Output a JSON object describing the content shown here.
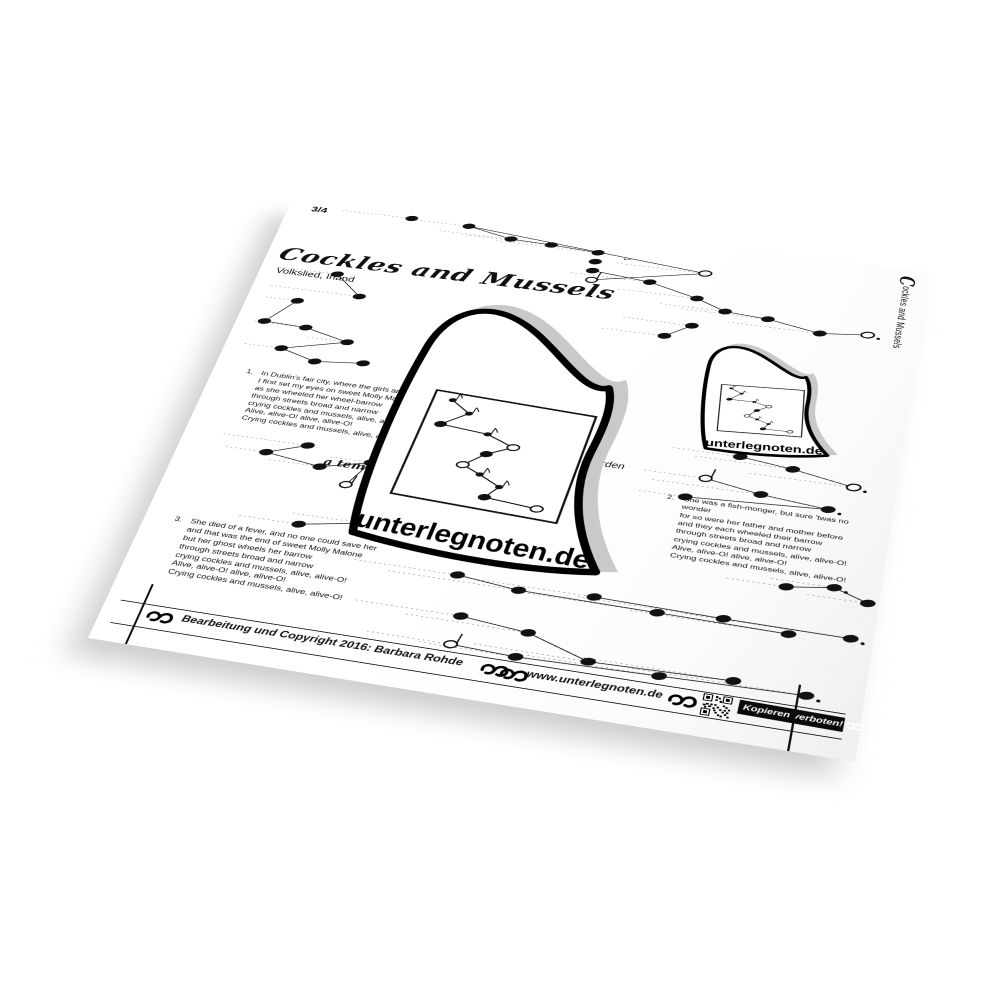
{
  "page": {
    "time_signature": "3/4",
    "title": "Cockles and Mussels",
    "subtitle": "Volkslied, Irland",
    "side_label_initial": "C",
    "side_label_rest": "ockles and Mussels",
    "tempo_a_tempo": "a tempo",
    "tempo_rit": "langsamer werden",
    "verses": [
      {
        "number": "1.",
        "lines": [
          "In Dublin's fair city, where the girls are so pretty",
          "I first set my eyes on sweet Molly Malone",
          "as she wheeled her wheel-barrow",
          "through streets broad and narrow",
          "crying cockles and mussels, alive, alive-O!",
          "Alive, alive-O! alive, alive-O!",
          "Crying cockles and mussels, alive, alive-O!"
        ]
      },
      {
        "number": "2.",
        "lines": [
          "She was a fish-monger, but sure 'twas no wonder",
          "for so were her father and mother before",
          "and they each wheeled their barrow",
          "through streets broad and narrow",
          "crying cockles and mussels, alive, alive-O!",
          "Alive, alive-O! alive, alive-O!",
          "Crying cockles and mussels, alive, alive-O!"
        ]
      },
      {
        "number": "3.",
        "lines": [
          "She died of a fever, and no one could save her",
          "and that was the end of sweet Molly Malone",
          "but her ghost wheels her barrow",
          "through streets broad and narrow",
          "crying cockles and mussels, alive, alive-O!",
          "Alive, alive-O! alive, alive-O!",
          "Crying cockles and mussels, alive, alive-O!"
        ]
      }
    ],
    "footer": {
      "copyright": "Bearbeitung und Copyright 2016: Barbara Rohde",
      "website": "www.unterlegnoten.de",
      "warning": "Kopieren verboten!"
    },
    "logo": {
      "brand": "unterlegnoten.de",
      "motif": [
        [
          12,
          7,
          "s"
        ],
        [
          25,
          17,
          "s"
        ],
        [
          11,
          31,
          "q"
        ],
        [
          41,
          33,
          "s"
        ],
        [
          59,
          41,
          "o"
        ],
        [
          45,
          51,
          "q"
        ],
        [
          34,
          64,
          "o"
        ],
        [
          46,
          70,
          "s"
        ],
        [
          60,
          78,
          "s"
        ],
        [
          54,
          89,
          "q"
        ],
        [
          86,
          91,
          "o"
        ]
      ]
    },
    "notation": {
      "arrow": {
        "x": 378,
        "y": 42,
        "glyph": "←"
      },
      "notes": [
        [
          140,
          12,
          "q"
        ],
        [
          205,
          14,
          "q"
        ],
        [
          255,
          28,
          "q"
        ],
        [
          300,
          30,
          "q"
        ],
        [
          352,
          34,
          "q"
        ],
        [
          352,
          50,
          "q"
        ],
        [
          352,
          66,
          "q"
        ],
        [
          354,
          82,
          "os"
        ],
        [
          470,
          48,
          "o"
        ],
        [
          415,
          74,
          "q"
        ],
        [
          468,
          92,
          "q"
        ],
        [
          500,
          108,
          "q"
        ],
        [
          545,
          112,
          "q"
        ],
        [
          600,
          125,
          "q"
        ],
        [
          648,
          118,
          "o",
          1
        ],
        [
          470,
          138,
          "q"
        ],
        [
          445,
          160,
          "q"
        ],
        [
          85,
          125,
          "q"
        ],
        [
          118,
          158,
          "q"
        ],
        [
          55,
          178,
          "q"
        ],
        [
          30,
          218,
          "q"
        ],
        [
          76,
          220,
          "q"
        ],
        [
          125,
          235,
          "q"
        ],
        [
          60,
          258,
          "q"
        ],
        [
          100,
          272,
          "q"
        ],
        [
          150,
          265,
          "q"
        ],
        [
          128,
          400,
          "q"
        ],
        [
          90,
          418,
          "q"
        ],
        [
          148,
          428,
          "q"
        ],
        [
          196,
          412,
          "q"
        ],
        [
          180,
          448,
          "os"
        ],
        [
          548,
          330,
          "q"
        ],
        [
          600,
          338,
          "q"
        ],
        [
          660,
          352,
          "o",
          1
        ],
        [
          520,
          368,
          "os"
        ],
        [
          575,
          380,
          "q"
        ],
        [
          640,
          388,
          "q",
          1
        ],
        [
          505,
          398,
          "q"
        ],
        [
          615,
          500,
          "q"
        ],
        [
          658,
          492,
          "q",
          1
        ],
        [
          690,
          506,
          "q"
        ],
        [
          315,
          548,
          "q"
        ],
        [
          375,
          556,
          "q"
        ],
        [
          445,
          550,
          "q"
        ],
        [
          505,
          558,
          "q"
        ],
        [
          565,
          553,
          "q"
        ],
        [
          625,
          560,
          "q"
        ],
        [
          680,
          554,
          "q",
          1
        ],
        [
          330,
          600,
          "q"
        ],
        [
          395,
          608,
          "q"
        ],
        [
          329,
          637,
          "os"
        ],
        [
          390,
          640,
          "q"
        ],
        [
          455,
          632,
          "q"
        ],
        [
          520,
          636,
          "q"
        ],
        [
          585,
          628,
          "q"
        ],
        [
          650,
          632,
          "q",
          1
        ],
        [
          270,
          478,
          "q"
        ],
        [
          210,
          498,
          "q"
        ],
        [
          150,
          512,
          "q"
        ]
      ],
      "edges": [
        [
          1,
          2
        ],
        [
          1,
          8
        ],
        [
          2,
          3
        ],
        [
          3,
          4
        ],
        [
          6,
          9
        ],
        [
          7,
          8
        ],
        [
          9,
          10
        ],
        [
          10,
          11
        ],
        [
          11,
          12
        ],
        [
          12,
          13
        ],
        [
          13,
          14
        ],
        [
          15,
          16
        ],
        [
          17,
          18
        ],
        [
          19,
          20
        ],
        [
          20,
          21
        ],
        [
          21,
          22
        ],
        [
          22,
          23
        ],
        [
          23,
          24
        ],
        [
          24,
          25
        ],
        [
          26,
          27
        ],
        [
          27,
          28
        ],
        [
          28,
          29
        ],
        [
          29,
          30
        ],
        [
          31,
          32
        ],
        [
          32,
          33
        ],
        [
          34,
          35
        ],
        [
          35,
          36
        ],
        [
          36,
          37
        ],
        [
          38,
          39
        ],
        [
          39,
          40
        ],
        [
          41,
          42
        ],
        [
          42,
          44
        ],
        [
          43,
          45
        ],
        [
          44,
          46
        ],
        [
          45,
          47
        ],
        [
          48,
          49
        ],
        [
          49,
          52
        ],
        [
          50,
          51
        ],
        [
          51,
          53
        ],
        [
          52,
          54
        ],
        [
          53,
          55
        ],
        [
          56,
          57
        ],
        [
          57,
          58
        ]
      ],
      "guides": [
        [
          60,
          134,
          12
        ],
        [
          145,
          199,
          14
        ],
        [
          175,
          249,
          28
        ],
        [
          205,
          294,
          30
        ],
        [
          240,
          346,
          34
        ],
        [
          375,
          464,
          48
        ],
        [
          330,
          409,
          74
        ],
        [
          385,
          462,
          92
        ],
        [
          432,
          494,
          108
        ],
        [
          455,
          539,
          112
        ],
        [
          505,
          594,
          125
        ],
        [
          398,
          464,
          138
        ],
        [
          380,
          439,
          160
        ],
        [
          20,
          79,
          125
        ],
        [
          20,
          112,
          158
        ],
        [
          20,
          49,
          178
        ],
        [
          20,
          70,
          220
        ],
        [
          82,
          119,
          235
        ],
        [
          20,
          54,
          258
        ],
        [
          40,
          122,
          400
        ],
        [
          48,
          84,
          418
        ],
        [
          96,
          142,
          428
        ],
        [
          155,
          190,
          412
        ],
        [
          482,
          542,
          330
        ],
        [
          505,
          594,
          338
        ],
        [
          560,
          654,
          352
        ],
        [
          460,
          514,
          368
        ],
        [
          470,
          569,
          380
        ],
        [
          460,
          499,
          398
        ],
        [
          560,
          609,
          500
        ],
        [
          600,
          652,
          492
        ],
        [
          635,
          684,
          506
        ],
        [
          215,
          309,
          548
        ],
        [
          250,
          369,
          556
        ],
        [
          320,
          439,
          550
        ],
        [
          370,
          499,
          558
        ],
        [
          430,
          559,
          553
        ],
        [
          480,
          619,
          560
        ],
        [
          530,
          674,
          554
        ],
        [
          230,
          324,
          600
        ],
        [
          280,
          389,
          608
        ],
        [
          250,
          323,
          637
        ],
        [
          300,
          384,
          640
        ],
        [
          350,
          449,
          632
        ],
        [
          400,
          514,
          636
        ],
        [
          450,
          579,
          628
        ],
        [
          495,
          644,
          632
        ],
        [
          200,
          264,
          478
        ],
        [
          140,
          204,
          498
        ],
        [
          90,
          144,
          512
        ]
      ]
    },
    "colors": {
      "ink": "#111111",
      "paper": "#ffffff",
      "shadow_gray": "#c9c9c9"
    }
  }
}
